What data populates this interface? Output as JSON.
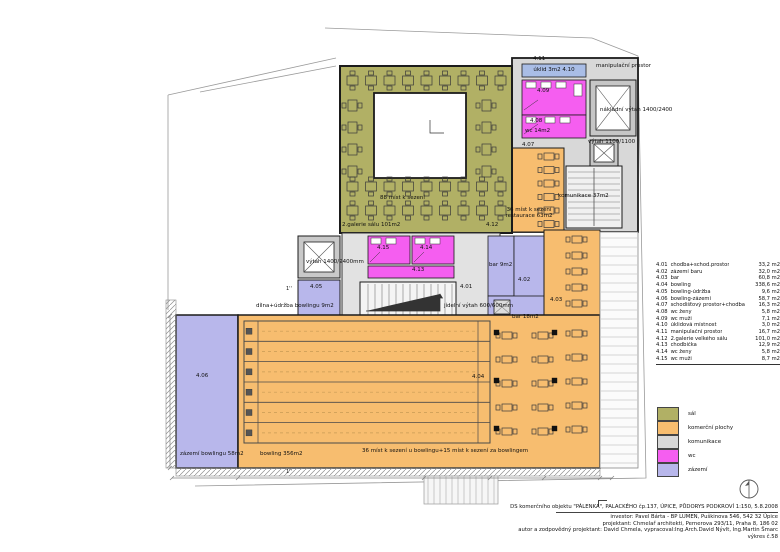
{
  "colors": {
    "sal": "#b1b065",
    "komercni": "#f7bd6f",
    "komunikace": "#d8d8d8",
    "wc": "#f55ef0",
    "zazemi": "#b8b7eb",
    "uklid": "#a9bde6",
    "stair": "#f0f0f0",
    "wall": "#1b1b1b",
    "boundary": "#9a9a9a"
  },
  "plan": {
    "labels": {
      "r411": "4.11",
      "uklid": "úklid 3m2 4.10",
      "manip": "manipulační prostor",
      "r409": "4.09",
      "nakladni": "nákladní výtah 1400/2400",
      "r408": "4.08",
      "wc14": "wc 14m2",
      "vytah1100": "výtah 1100/1100",
      "r407": "4.07",
      "komunikace": "komunikace 37m2",
      "mist88": "88 míst k sezení",
      "galerie": "2.galerie sálu 101m2",
      "r412": "4.12",
      "rest1": "36 míst k sezení",
      "rest2": "restaurace 63m2",
      "vytah1400": "výtah 1400/2400mm",
      "r415": "4.15",
      "r414": "4.14",
      "r413": "4.13",
      "r405": "4.05",
      "dilna": "dílna+údržba bowlingu 9m2",
      "r401": "4.01",
      "bar9": "bar 9m2",
      "r402": "4.02",
      "jidelni": "jídelní výtah 600/600mm",
      "bar18": "bar 18m2",
      "r403": "4.03",
      "r406": "4.06",
      "r404": "4.04",
      "zazemi58": "zázemí bowlingu 58m2",
      "bowling356": "bowling 356m2",
      "mist36": "36 míst k sezení u bowlingu+15 míst k sezení za bowlingem",
      "s1": "1''",
      "s2": "1''"
    }
  },
  "room_table": {
    "rows": [
      {
        "no": "4.01",
        "name": "chodba+schod.prostor",
        "area": "33,2 m2"
      },
      {
        "no": "4.02",
        "name": "zázemí baru",
        "area": "32,0 m2"
      },
      {
        "no": "4.03",
        "name": "bar",
        "area": "60,8 m2"
      },
      {
        "no": "4.04",
        "name": "bowling",
        "area": "338,6 m2"
      },
      {
        "no": "4.05",
        "name": "bowling-údržba",
        "area": "9,6 m2"
      },
      {
        "no": "4.06",
        "name": "bowling-zázemí",
        "area": "58,7 m2"
      },
      {
        "no": "4.07",
        "name": "schodišťový prostor+chodba",
        "area": "16,3 m2"
      },
      {
        "no": "4.08",
        "name": "wc ženy",
        "area": "5,8 m2"
      },
      {
        "no": "4.09",
        "name": "wc muži",
        "area": "7,1 m2"
      },
      {
        "no": "4.10",
        "name": "úklidová místnost",
        "area": "3,0 m2"
      },
      {
        "no": "4.11",
        "name": "manipulační prostor",
        "area": "16,7 m2"
      },
      {
        "no": "4.12",
        "name": "2.galerie velkého sálu",
        "area": "101,0 m2"
      },
      {
        "no": "4.13",
        "name": "chodbička",
        "area": "12,9 m2"
      },
      {
        "no": "4.14",
        "name": "wc ženy",
        "area": "5,8 m2"
      },
      {
        "no": "4.15",
        "name": "wc muži",
        "area": "8,7 m2"
      }
    ]
  },
  "legend": {
    "items": [
      {
        "label": "sál",
        "color": "#b1b065"
      },
      {
        "label": "komerční plochy",
        "color": "#f7bd6f"
      },
      {
        "label": "komunikace",
        "color": "#d8d8d8"
      },
      {
        "label": "wc",
        "color": "#f55ef0"
      },
      {
        "label": "zázemí",
        "color": "#b8b7eb"
      }
    ]
  },
  "title_block": {
    "line1": "DS komerčního objektu \"PÁLENKA\", PALACKÉHO čp.137, ÚPICE, PŮDORYS PODKROVÍ 1:150,  5.8.2008",
    "investor": "investor: Pavel Bárta - BP LUMEN, Puškinova 546, 542 32  Úpice",
    "projektant": "projektant: Chmelař architekti, Pernerova 293/11, Praha 8, 186 02",
    "autor": "autor a zodpovědný projektant: David Chmela, vypracoval:Ing.Arch.David Nývlt, Ing.Martin Šmarc",
    "vykres": "výkres č.58"
  }
}
